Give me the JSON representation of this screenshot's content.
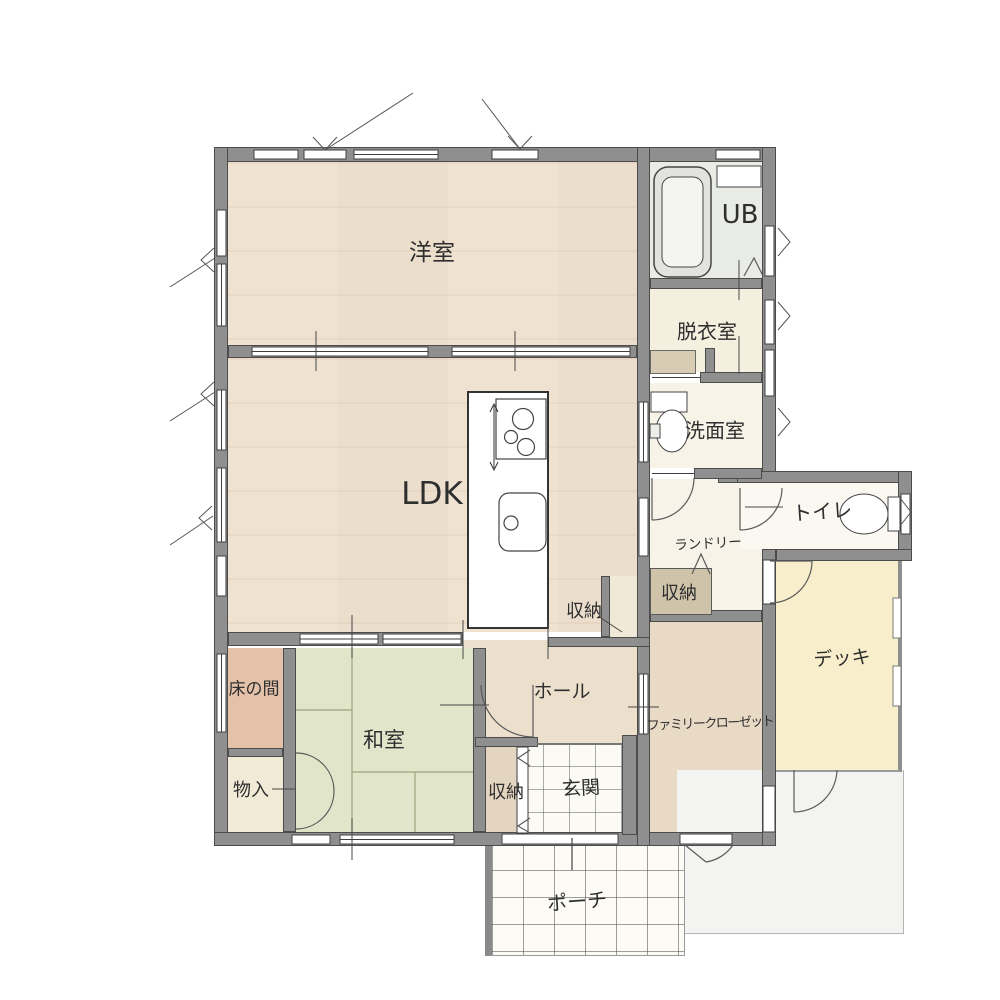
{
  "meta": {
    "type": "japanese-house-floor-plan",
    "floor": "1F"
  },
  "rooms": {
    "yoshitsu": "洋室",
    "ub": "UB",
    "datsuishitsu": "脱衣室",
    "ldk": "LDK",
    "senmenshitsu": "洗面室",
    "toilet": "トイレ",
    "laundry": "ランドリー",
    "storage_laundry": "収納",
    "storage_ldk": "収納",
    "tokonoma": "床の間",
    "washitsu": "和室",
    "monoire": "物入",
    "hall": "ホール",
    "family_closet": "ファミリークローゼット",
    "storage_genkan": "収納",
    "genkan": "玄関",
    "deck": "デッキ",
    "porch": "ポーチ"
  },
  "fixtures": {
    "bathtub": "bathtub-icon",
    "washbasin": "washbasin-icon",
    "toilet_bowl": "toilet-icon",
    "stove": "gas-stove-icon",
    "kitchen_sink": "kitchen-sink-icon"
  },
  "colors": {
    "wall": "#8f8f8f",
    "wood_floor": "#f2e7d8",
    "tatami_green": "#e1e6cb",
    "tokonoma_salmon": "#e4c2aa",
    "deck_yellow": "#f8eecb",
    "tile_white": "#fbfaf4",
    "closet_tan": "#e9dac6",
    "storage_box_tan": "#cfc3aa",
    "bath_gray": "#e9ebe7"
  }
}
